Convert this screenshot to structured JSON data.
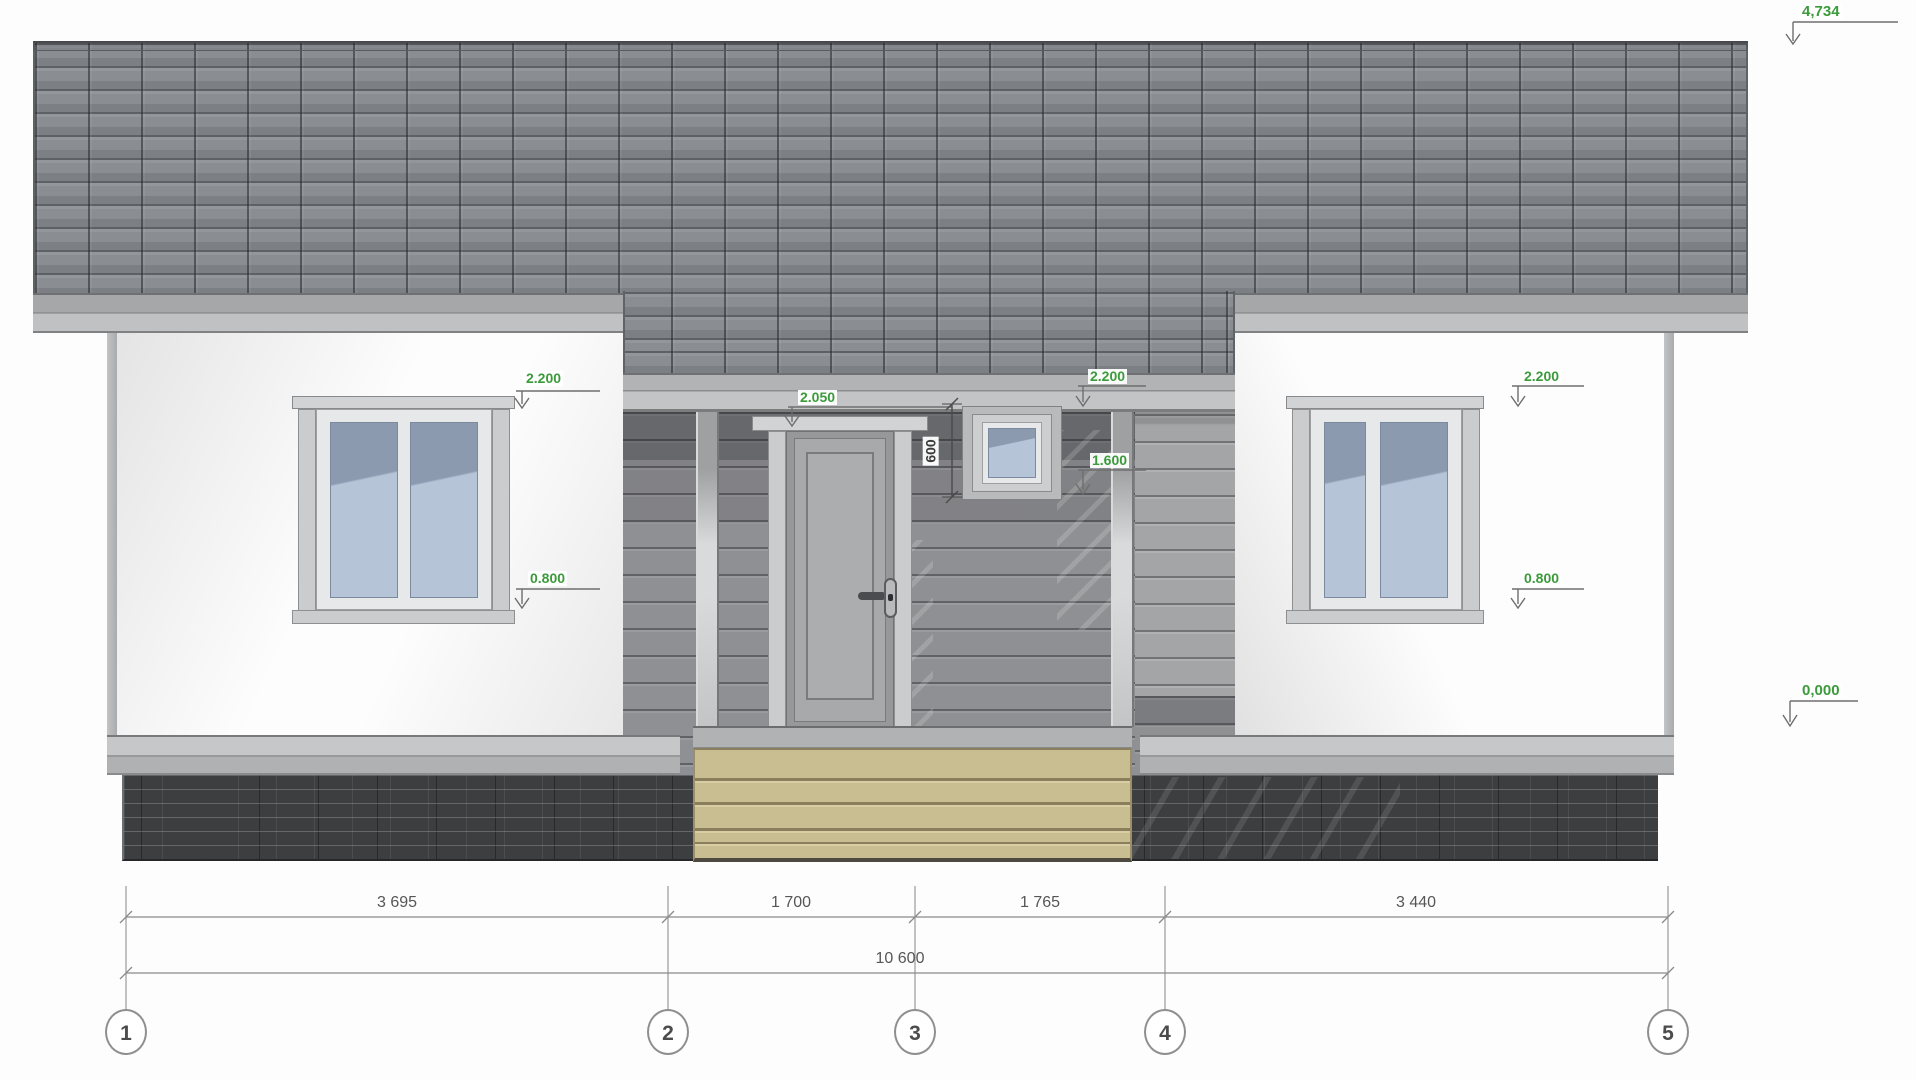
{
  "drawing": {
    "type_label": "house-front-elevation"
  },
  "annotations": {
    "levels": {
      "roof_peak": "4,734",
      "ground": "0,000",
      "window_left_head": "2.200",
      "window_right_head": "2.200",
      "small_window_head": "2.200",
      "door_head": "2.050",
      "small_window_sill": "1.600",
      "window_left_sill": "0.800",
      "window_right_sill": "0.800"
    },
    "small_window_height": "600"
  },
  "dimensions": {
    "segments": [
      "3 695",
      "1 700",
      "1 765",
      "3 440"
    ],
    "total": "10 600"
  },
  "grid": {
    "bubbles": [
      "1",
      "2",
      "3",
      "4",
      "5"
    ]
  },
  "colors": {
    "accent-green": "#3b9b3b",
    "dim-line": "#8f8f8f",
    "roof-tile": "#8a8e93",
    "wall": "#a4a5a7",
    "steps-wood": "#c9bd92",
    "foundation": "#3d3e40",
    "glass-top": "#8b9aae",
    "glass-bottom": "#b5c4d7"
  }
}
